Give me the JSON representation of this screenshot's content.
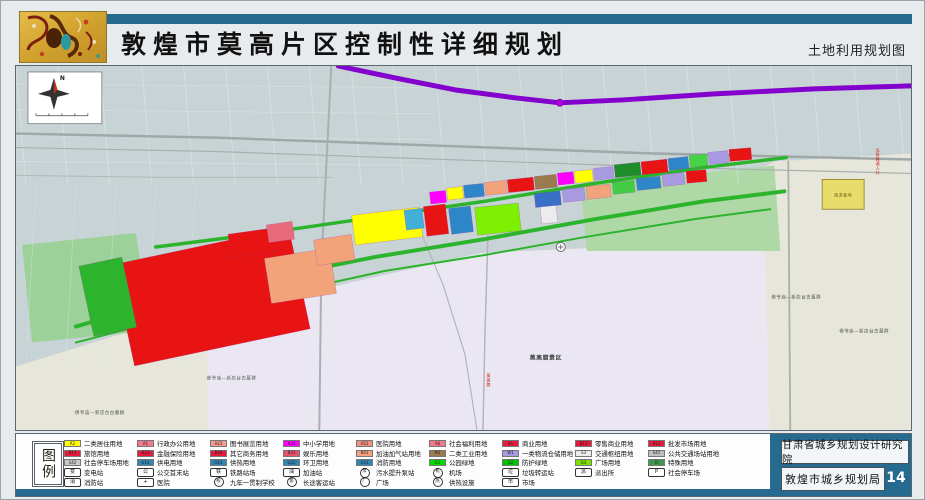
{
  "header": {
    "title": "敦煌市莫高片区控制性详细规划",
    "subtitle": "土地利用规划图"
  },
  "theme": {
    "teal": "#266a90",
    "highway_purple": "#8400cc",
    "green_road": "#2db42d"
  },
  "footer": {
    "institute": "甘肃省城乡规划设计研究院",
    "bureau": "敦煌市城乡规划局",
    "page_number": "14"
  },
  "legend": {
    "title": "图例",
    "columns": [
      {
        "items": [
          {
            "type": "swatch",
            "code": "R2",
            "color": "#ffff00",
            "label": "二类居住用地"
          },
          {
            "type": "swatch",
            "code": "B14",
            "color": "#e8193c",
            "label": "旅馆用地"
          },
          {
            "type": "swatch",
            "code": "S42",
            "color": "#c9c9c9",
            "label": "社会停车场用地"
          },
          {
            "type": "icon",
            "shape": "box",
            "glyph": "变",
            "label": "变电站"
          },
          {
            "type": "icon",
            "shape": "box",
            "glyph": "消",
            "label": "消防站"
          }
        ]
      },
      {
        "items": [
          {
            "type": "swatch",
            "code": "A1",
            "color": "#f2788c",
            "label": "行政办公用地"
          },
          {
            "type": "swatch",
            "code": "B21",
            "color": "#e8193c",
            "label": "金融保险用地"
          },
          {
            "type": "swatch",
            "code": "U12",
            "color": "#2e86b4",
            "label": "供电用地"
          },
          {
            "type": "icon",
            "shape": "box",
            "glyph": "公",
            "label": "公交首末站"
          },
          {
            "type": "icon",
            "shape": "box",
            "glyph": "+",
            "label": "医院"
          }
        ]
      },
      {
        "items": [
          {
            "type": "swatch",
            "code": "A21",
            "color": "#f49a8c",
            "label": "图书展览用地"
          },
          {
            "type": "swatch",
            "code": "B29",
            "color": "#e8193c",
            "label": "其它商务用地"
          },
          {
            "type": "swatch",
            "code": "U15",
            "color": "#2e86b4",
            "label": "供热用地"
          },
          {
            "type": "icon",
            "shape": "box",
            "glyph": "铁",
            "label": "铁路站场"
          },
          {
            "type": "icon",
            "shape": "circle",
            "glyph": "校",
            "label": "九年一贯制学校"
          }
        ]
      },
      {
        "items": [
          {
            "type": "swatch",
            "code": "A33",
            "color": "#ff00ff",
            "label": "中小学用地"
          },
          {
            "type": "swatch",
            "code": "B31",
            "color": "#e8506c",
            "label": "娱乐用地"
          },
          {
            "type": "swatch",
            "code": "U22",
            "color": "#2e86b4",
            "label": "环卫用地"
          },
          {
            "type": "icon",
            "shape": "box",
            "glyph": "油",
            "label": "加油站"
          },
          {
            "type": "icon",
            "shape": "circle",
            "glyph": "客",
            "label": "长途客运站"
          }
        ]
      },
      {
        "items": [
          {
            "type": "swatch",
            "code": "A51",
            "color": "#f4907c",
            "label": "医院用地"
          },
          {
            "type": "swatch",
            "code": "B41",
            "color": "#f4a07c",
            "label": "加油加气站用地"
          },
          {
            "type": "swatch",
            "code": "U31",
            "color": "#2e86b4",
            "label": "消防用地"
          },
          {
            "type": "icon",
            "shape": "circle",
            "glyph": "泵",
            "label": "污水提升泵站"
          },
          {
            "type": "icon",
            "shape": "circle",
            "glyph": "广",
            "label": "广场"
          }
        ]
      },
      {
        "items": [
          {
            "type": "swatch",
            "code": "A6",
            "color": "#f4788c",
            "label": "社会福利用地"
          },
          {
            "type": "swatch",
            "code": "M2",
            "color": "#9c7a50",
            "label": "二类工业用地"
          },
          {
            "type": "swatch",
            "code": "G1",
            "color": "#00dc00",
            "label": "公园绿地"
          },
          {
            "type": "icon",
            "shape": "circle",
            "glyph": "机",
            "label": "机场"
          },
          {
            "type": "icon",
            "shape": "circle",
            "glyph": "热",
            "label": "供热设施"
          }
        ]
      },
      {
        "items": [
          {
            "type": "swatch",
            "code": "B1",
            "color": "#e8193c",
            "label": "商业用地"
          },
          {
            "type": "swatch",
            "code": "W1",
            "color": "#a89ae0",
            "label": "一类物流仓储用地"
          },
          {
            "type": "swatch",
            "code": "G2",
            "color": "#00c400",
            "label": "防护绿地"
          },
          {
            "type": "icon",
            "shape": "box",
            "glyph": "垃",
            "label": "垃圾转运站"
          },
          {
            "type": "icon",
            "shape": "box",
            "glyph": "市",
            "label": "市场"
          }
        ]
      },
      {
        "items": [
          {
            "type": "swatch",
            "code": "B11",
            "color": "#e8193c",
            "label": "零售商业用地"
          },
          {
            "type": "swatch",
            "code": "S3",
            "color": "#ececec",
            "label": "交通枢纽用地"
          },
          {
            "type": "swatch",
            "code": "G3",
            "color": "#7ce000",
            "label": "广场用地"
          },
          {
            "type": "icon",
            "shape": "box",
            "glyph": "派",
            "label": "派出所"
          }
        ]
      },
      {
        "items": [
          {
            "type": "swatch",
            "code": "B12",
            "color": "#e8193c",
            "label": "批发市场用地"
          },
          {
            "type": "swatch",
            "code": "S41",
            "color": "#c0c0c0",
            "label": "公共交通场站用地"
          },
          {
            "type": "swatch",
            "code": "D",
            "color": "#3c9650",
            "label": "特殊用地"
          },
          {
            "type": "icon",
            "shape": "box",
            "glyph": "P",
            "label": "社会停车场"
          }
        ]
      }
    ]
  },
  "map": {
    "compass": "N",
    "areas": [
      {
        "name": "satellite-base",
        "pts": "0,0 897,0 897,366 0,366",
        "fill": "#c8d3d5"
      },
      {
        "name": "desert-area",
        "pts": "0,302 191,243 300,226 466,188 600,182 760,96 897,88 897,366 0,366",
        "fill": "#e6e6da"
      },
      {
        "name": "mogao-scenic-area",
        "pts": "191,243 300,226 466,188 600,182 751,181 755,366 193,366",
        "fill": "#eae7f2"
      },
      {
        "name": "green-area-right",
        "pts": "566,120 760,100 766,186 572,186",
        "fill": "#aed8a6"
      },
      {
        "name": "green-area-left",
        "pts": "6,180 120,168 136,266 16,278",
        "fill": "#9cd29a"
      }
    ],
    "roads": [
      {
        "pts": "0,68 200,72 420,80 640,88 897,94",
        "w": 2.5,
        "c": "#9fa8a8"
      },
      {
        "pts": "0,82 200,86 430,94 660,102 897,108",
        "w": 1.2,
        "c": "#a8b0b0"
      },
      {
        "pts": "316,0 312,80 306,200 304,366",
        "w": 2,
        "c": "#a8b0b0"
      },
      {
        "pts": "473,170 470,270 468,366",
        "w": 1.5,
        "c": "#b4b4bc"
      },
      {
        "pts": "774,96 776,366",
        "w": 1.8,
        "c": "#a8b0a8"
      },
      {
        "pts": "406,168 428,220 450,290 462,366",
        "w": 1.2,
        "c": "#b4b4bc"
      },
      {
        "pts": "0,110 150,112 316,112",
        "w": 1,
        "c": "#b0b8b8"
      }
    ],
    "green_lines": [
      {
        "pts": "60,262 150,236 260,212 360,192 470,174 580,154 690,136 770,126",
        "w": 4
      },
      {
        "pts": "140,182 250,168 360,152 470,136 580,118 690,102 772,92",
        "w": 3.5
      },
      {
        "pts": "60,278 160,252 270,228 370,206 470,190 570,172 680,154 756,144",
        "w": 2
      }
    ],
    "highway": {
      "pts": "323,0 380,12 440,24 500,32 545,37 610,34 700,28 800,23 897,20",
      "w": 5,
      "node": {
        "x": 545,
        "y": 37
      }
    },
    "parcels": [
      {
        "x": 106,
        "y": 180,
        "w": 180,
        "h": 104,
        "r": -12,
        "c": "#e81414"
      },
      {
        "x": 70,
        "y": 196,
        "w": 44,
        "h": 72,
        "r": -12,
        "c": "#2db42d"
      },
      {
        "x": 252,
        "y": 188,
        "w": 66,
        "h": 46,
        "r": -9,
        "c": "#f2a37a"
      },
      {
        "x": 300,
        "y": 172,
        "w": 38,
        "h": 26,
        "r": -9,
        "c": "#f2a37a"
      },
      {
        "x": 214,
        "y": 166,
        "w": 44,
        "h": 24,
        "r": -8,
        "c": "#e81414"
      },
      {
        "x": 252,
        "y": 158,
        "w": 26,
        "h": 18,
        "r": -8,
        "c": "#e86a7a"
      },
      {
        "x": 338,
        "y": 146,
        "w": 68,
        "h": 30,
        "r": -7,
        "c": "#ffff00"
      },
      {
        "x": 390,
        "y": 144,
        "w": 18,
        "h": 20,
        "r": -7,
        "c": "#40b0d8"
      },
      {
        "x": 410,
        "y": 140,
        "w": 22,
        "h": 30,
        "r": -7,
        "c": "#e81414"
      },
      {
        "x": 435,
        "y": 142,
        "w": 22,
        "h": 26,
        "r": -7,
        "c": "#2e86c8"
      },
      {
        "x": 461,
        "y": 140,
        "w": 44,
        "h": 28,
        "r": -6,
        "c": "#7cf000"
      },
      {
        "x": 526,
        "y": 138,
        "w": 16,
        "h": 20,
        "r": -6,
        "c": "#ececec"
      },
      {
        "x": 415,
        "y": 126,
        "w": 16,
        "h": 12,
        "r": -6,
        "c": "#ff00ff"
      },
      {
        "x": 432,
        "y": 122,
        "w": 16,
        "h": 12,
        "r": -6,
        "c": "#ffff00"
      },
      {
        "x": 449,
        "y": 119,
        "w": 20,
        "h": 13,
        "r": -6,
        "c": "#2e86c8"
      },
      {
        "x": 470,
        "y": 116,
        "w": 22,
        "h": 13,
        "r": -6,
        "c": "#f2a37a"
      },
      {
        "x": 493,
        "y": 113,
        "w": 26,
        "h": 13,
        "r": -6,
        "c": "#e81414"
      },
      {
        "x": 520,
        "y": 110,
        "w": 22,
        "h": 13,
        "r": -6,
        "c": "#9c7a50"
      },
      {
        "x": 543,
        "y": 107,
        "w": 16,
        "h": 12,
        "r": -6,
        "c": "#ff00ff"
      },
      {
        "x": 560,
        "y": 105,
        "w": 18,
        "h": 12,
        "r": -6,
        "c": "#ffff00"
      },
      {
        "x": 579,
        "y": 102,
        "w": 20,
        "h": 12,
        "r": -6,
        "c": "#a89ae0"
      },
      {
        "x": 600,
        "y": 98,
        "w": 26,
        "h": 13,
        "r": -6,
        "c": "#1e8c28"
      },
      {
        "x": 627,
        "y": 95,
        "w": 26,
        "h": 13,
        "r": -6,
        "c": "#e81414"
      },
      {
        "x": 654,
        "y": 92,
        "w": 20,
        "h": 12,
        "r": -6,
        "c": "#2e86c8"
      },
      {
        "x": 675,
        "y": 89,
        "w": 18,
        "h": 12,
        "r": -5,
        "c": "#44d444"
      },
      {
        "x": 694,
        "y": 86,
        "w": 20,
        "h": 12,
        "r": -5,
        "c": "#a89ae0"
      },
      {
        "x": 715,
        "y": 83,
        "w": 22,
        "h": 12,
        "r": -5,
        "c": "#e81414"
      },
      {
        "x": 520,
        "y": 127,
        "w": 26,
        "h": 14,
        "r": -6,
        "c": "#3a6fc8"
      },
      {
        "x": 548,
        "y": 123,
        "w": 22,
        "h": 13,
        "r": -6,
        "c": "#a89ae0"
      },
      {
        "x": 572,
        "y": 120,
        "w": 24,
        "h": 13,
        "r": -6,
        "c": "#f2a37a"
      },
      {
        "x": 598,
        "y": 116,
        "w": 22,
        "h": 12,
        "r": -6,
        "c": "#44cc44"
      },
      {
        "x": 622,
        "y": 112,
        "w": 24,
        "h": 12,
        "r": -6,
        "c": "#2e86c8"
      },
      {
        "x": 648,
        "y": 108,
        "w": 22,
        "h": 12,
        "r": -6,
        "c": "#a89ae0"
      },
      {
        "x": 672,
        "y": 105,
        "w": 20,
        "h": 12,
        "r": -5,
        "c": "#e81414"
      },
      {
        "x": 808,
        "y": 114,
        "w": 42,
        "h": 30,
        "r": 0,
        "c": "#e8dc6a",
        "s": "#8a7a20",
        "sw": 0.8
      }
    ],
    "airport_symbol": {
      "x": 546,
      "y": 182
    },
    "labels": [
      {
        "text": "莫高窟景区",
        "x": 531,
        "y": 295,
        "size": 6,
        "color": "#444",
        "bold": true
      },
      {
        "text": "佛爷庙—新店台古墓群",
        "x": 216,
        "y": 315,
        "size": 4.5,
        "color": "#555"
      },
      {
        "text": "佛爷庙—新店台古墓群",
        "x": 84,
        "y": 350,
        "size": 4.5,
        "color": "#555"
      },
      {
        "text": "佛爷庙—新店台古墓群",
        "x": 782,
        "y": 234,
        "size": 4.5,
        "color": "#555"
      },
      {
        "text": "佛爷庙—新店台古墓群",
        "x": 850,
        "y": 268,
        "size": 4.5,
        "color": "#555"
      },
      {
        "text": "旅游基地",
        "x": 829,
        "y": 131,
        "size": 4,
        "color": "#6a5a10"
      },
      {
        "text": "瓜敦高速入口",
        "x": 864,
        "y": 96,
        "size": 4,
        "color": "#cc1111",
        "vertical": true
      },
      {
        "text": "莫高路",
        "x": 474,
        "y": 316,
        "size": 4,
        "color": "#cc1111",
        "vertical": true
      }
    ]
  }
}
